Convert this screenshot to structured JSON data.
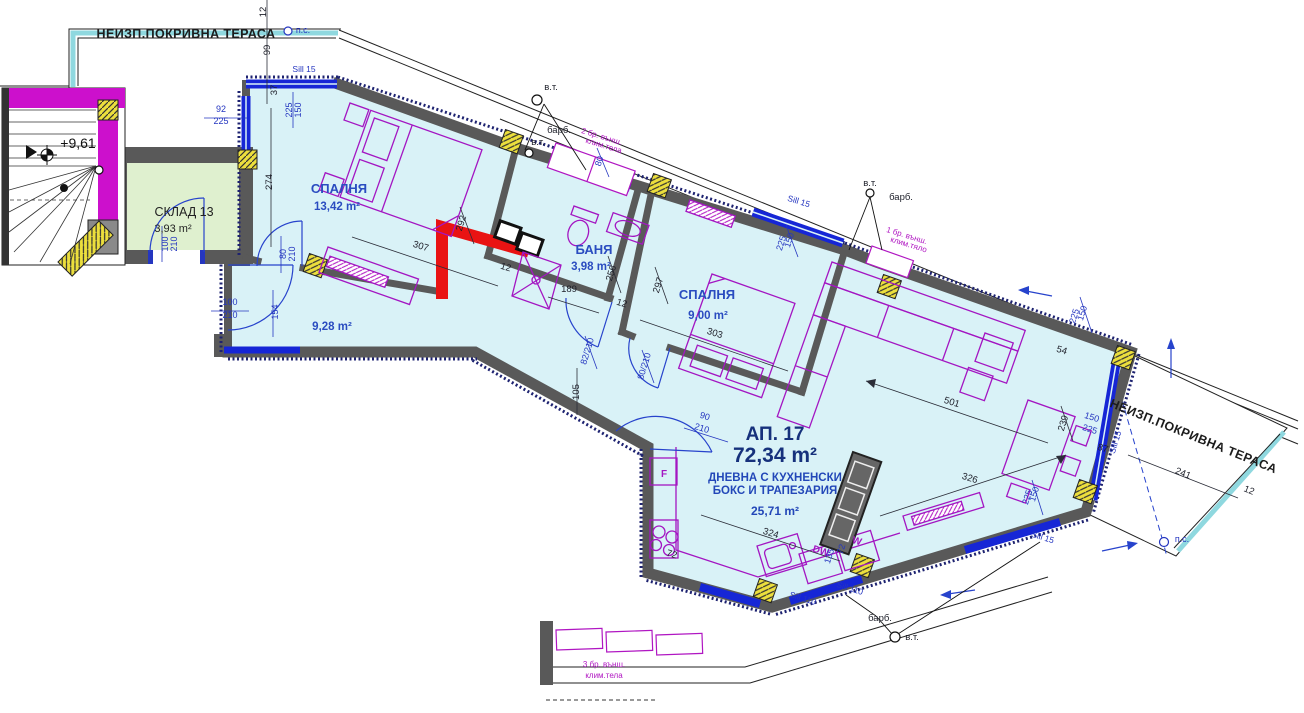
{
  "plan": {
    "apartment_no": "АП. 17",
    "apartment_area": "72,34 m²",
    "level_mark": "+9,61",
    "rooms": [
      {
        "name": "СПАЛНЯ",
        "area": "13,42 m²"
      },
      {
        "name": "БАНЯ",
        "area": "3,98 m²"
      },
      {
        "name": "СПАЛНЯ",
        "area": "9,00 m²"
      },
      {
        "name": "ДНЕВНА С КУХНЕНСКИ БОКС И ТРАПЕЗАРИЯ",
        "area": "25,71 m²"
      },
      {
        "name": "КОРИДОР",
        "area": "9,28 m²"
      },
      {
        "name": "СКЛАД 13",
        "area": "3,93 m²"
      }
    ],
    "terraces": [
      "НЕИЗП.ПОКРИВНА ТЕРАСА",
      "НЕИЗП.ПОКРИВНА ТЕРАСА"
    ],
    "colors": {
      "floor": "#d9f2f7",
      "storage": "#dff0cf",
      "wall": "#595959",
      "window": "#1626d6",
      "furniture": "#a316c2",
      "magenta_wall": "#cc10cc",
      "highlight": "#e91313",
      "vent": "#ecdf3d",
      "edge_cyan": "#8fd8df"
    }
  },
  "texts": [
    {
      "t": "НЕИЗП.ПОКРИВНА ТЕРАСА",
      "x": 186,
      "y": 38,
      "r": 0,
      "c": "tL",
      "n": "terrace-top-label"
    },
    {
      "t": "п.с.",
      "x": 303,
      "y": 33,
      "r": 0,
      "c": "dim",
      "n": "pc-label"
    },
    {
      "t": "12",
      "x": 266,
      "y": 12,
      "r": -90,
      "c": "blk",
      "n": "dim-label"
    },
    {
      "t": "99",
      "x": 270,
      "y": 50,
      "r": -90,
      "c": "blk",
      "n": "dim-label"
    },
    {
      "t": "Sill 15",
      "x": 304,
      "y": 72,
      "r": 0,
      "c": "sill",
      "n": "sill-label"
    },
    {
      "t": "92",
      "x": 221,
      "y": 112,
      "r": 0,
      "c": "dim",
      "n": "dim-label"
    },
    {
      "t": "225",
      "x": 221,
      "y": 124,
      "r": 0,
      "c": "dim",
      "n": "dim-label"
    },
    {
      "t": "150",
      "x": 301,
      "y": 110,
      "r": -90,
      "c": "dim",
      "n": "dim-label"
    },
    {
      "t": "225",
      "x": 292,
      "y": 110,
      "r": -90,
      "c": "dim",
      "n": "dim-label"
    },
    {
      "t": "37",
      "x": 277,
      "y": 90,
      "r": -90,
      "c": "blk",
      "n": "dim-label"
    },
    {
      "t": "274",
      "x": 272,
      "y": 182,
      "r": -90,
      "c": "blk",
      "n": "dim-label"
    },
    {
      "t": "+9,61",
      "x": 78,
      "y": 148,
      "r": 0,
      "c": "lvl",
      "n": "level-mark"
    },
    {
      "t": "СКЛАД 13",
      "x": 184,
      "y": 216,
      "r": 0,
      "c": "store",
      "n": "room-label-storage"
    },
    {
      "t": "3,93 m²",
      "x": 173,
      "y": 232,
      "r": 0,
      "c": "storeA",
      "n": "room-area-storage"
    },
    {
      "t": "100",
      "x": 168,
      "y": 244,
      "r": -90,
      "c": "dim",
      "n": "dim-label"
    },
    {
      "t": "210",
      "x": 177,
      "y": 244,
      "r": -90,
      "c": "dim",
      "n": "dim-label"
    },
    {
      "t": "100",
      "x": 230,
      "y": 305,
      "r": 0,
      "c": "dim",
      "n": "dim-label"
    },
    {
      "t": "210",
      "x": 230,
      "y": 318,
      "r": 0,
      "c": "dim",
      "n": "dim-label"
    },
    {
      "t": "154",
      "x": 278,
      "y": 312,
      "r": -90,
      "c": "dim",
      "n": "dim-label"
    },
    {
      "t": "80",
      "x": 286,
      "y": 254,
      "r": -90,
      "c": "dim",
      "n": "dim-label"
    },
    {
      "t": "210",
      "x": 295,
      "y": 254,
      "r": -90,
      "c": "dim",
      "n": "dim-label"
    },
    {
      "t": "СПАЛНЯ",
      "x": 339,
      "y": 193,
      "r": 0,
      "c": "room",
      "n": "room-label-bedroom1"
    },
    {
      "t": "13,42 m²",
      "x": 337,
      "y": 210,
      "r": 0,
      "c": "area",
      "n": "room-area-bedroom1"
    },
    {
      "t": "307",
      "x": 420,
      "y": 249,
      "r": 17,
      "c": "blk",
      "n": "dim-label"
    },
    {
      "t": "292",
      "x": 464,
      "y": 224,
      "r": -73,
      "c": "blk",
      "n": "dim-label"
    },
    {
      "t": "12",
      "x": 505,
      "y": 270,
      "r": 17,
      "c": "blk",
      "n": "dim-label"
    },
    {
      "t": "9,28 m²",
      "x": 332,
      "y": 330,
      "r": 0,
      "c": "area",
      "n": "room-area-hall"
    },
    {
      "t": "в.т.",
      "x": 551,
      "y": 90,
      "r": 0,
      "c": "blk",
      "n": "vt-label"
    },
    {
      "t": "барб.",
      "x": 559,
      "y": 133,
      "r": 0,
      "c": "blk",
      "n": "barb-label"
    },
    {
      "t": "в.т.",
      "x": 538,
      "y": 145,
      "r": 0,
      "c": "blk",
      "n": "vt-label"
    },
    {
      "t": "2 бр. външ.",
      "x": 601,
      "y": 139,
      "r": 17,
      "c": "mag",
      "n": "ac-note"
    },
    {
      "t": "клим.тела",
      "x": 603,
      "y": 148,
      "r": 17,
      "c": "mag",
      "n": "ac-note"
    },
    {
      "t": "80",
      "x": 602,
      "y": 162,
      "r": -73,
      "c": "dim",
      "n": "dim-label"
    },
    {
      "t": "БАНЯ",
      "x": 594,
      "y": 254,
      "r": 0,
      "c": "room",
      "n": "room-label-bath"
    },
    {
      "t": "3,98 m²",
      "x": 591,
      "y": 270,
      "r": 0,
      "c": "area",
      "n": "room-area-bath"
    },
    {
      "t": "256",
      "x": 614,
      "y": 274,
      "r": -73,
      "c": "blk",
      "n": "dim-label"
    },
    {
      "t": "189",
      "x": 569,
      "y": 292,
      "r": 0,
      "c": "blk",
      "n": "dim-label"
    },
    {
      "t": "297",
      "x": 661,
      "y": 286,
      "r": -73,
      "c": "blk",
      "n": "dim-label"
    },
    {
      "t": "СПАЛНЯ",
      "x": 707,
      "y": 299,
      "r": 0,
      "c": "room",
      "n": "room-label-bedroom2"
    },
    {
      "t": "9,00 m²",
      "x": 708,
      "y": 319,
      "r": 0,
      "c": "area",
      "n": "room-area-bedroom2"
    },
    {
      "t": "303",
      "x": 714,
      "y": 336,
      "r": 17,
      "c": "blk",
      "n": "dim-label"
    },
    {
      "t": "12",
      "x": 621,
      "y": 306,
      "r": 17,
      "c": "blk",
      "n": "dim-label"
    },
    {
      "t": "82/210",
      "x": 590,
      "y": 352,
      "r": -73,
      "c": "dim",
      "n": "dim-label"
    },
    {
      "t": "80/210",
      "x": 647,
      "y": 367,
      "r": -73,
      "c": "dim",
      "n": "dim-label"
    },
    {
      "t": "105",
      "x": 579,
      "y": 392,
      "r": -90,
      "c": "blk",
      "n": "dim-label"
    },
    {
      "t": "90",
      "x": 704,
      "y": 419,
      "r": 17,
      "c": "dim",
      "n": "dim-label"
    },
    {
      "t": "210",
      "x": 701,
      "y": 431,
      "r": 17,
      "c": "dim",
      "n": "dim-label"
    },
    {
      "t": "АП. 17",
      "x": 775,
      "y": 440,
      "r": 0,
      "c": "big1",
      "n": "apartment-number"
    },
    {
      "t": "72,34 m²",
      "x": 775,
      "y": 462,
      "r": 0,
      "c": "big2",
      "n": "apartment-area"
    },
    {
      "t": "ДНЕВНА С КУХНЕНСКИ",
      "x": 775,
      "y": 481,
      "r": 0,
      "c": "liv",
      "n": "room-label-living"
    },
    {
      "t": "БОКС И ТРАПЕЗАРИЯ",
      "x": 775,
      "y": 494,
      "r": 0,
      "c": "liv",
      "n": "room-label-living2"
    },
    {
      "t": "25,71 m²",
      "x": 775,
      "y": 515,
      "r": 0,
      "c": "livA",
      "n": "room-area-living"
    },
    {
      "t": "324",
      "x": 770,
      "y": 536,
      "r": 17,
      "c": "blk",
      "n": "dim-label"
    },
    {
      "t": "F",
      "x": 664,
      "y": 477,
      "r": 0,
      "c": "magF",
      "n": "fridge-label"
    },
    {
      "t": "72",
      "x": 671,
      "y": 557,
      "r": 17,
      "c": "blk",
      "n": "dim-label"
    },
    {
      "t": "DW",
      "x": 820,
      "y": 554,
      "r": 17,
      "c": "magF",
      "n": "dishwasher-label"
    },
    {
      "t": "135",
      "x": 832,
      "y": 557,
      "r": -73,
      "c": "dim",
      "n": "dim-label"
    },
    {
      "t": "W",
      "x": 856,
      "y": 544,
      "r": 17,
      "c": "magF",
      "n": "washer-label"
    },
    {
      "t": "72",
      "x": 844,
      "y": 550,
      "r": -73,
      "c": "dim",
      "n": "dim-label"
    },
    {
      "t": "Sill 110",
      "x": 802,
      "y": 601,
      "r": 17,
      "c": "sill",
      "n": "sill-label"
    },
    {
      "t": "Sill 110",
      "x": 849,
      "y": 591,
      "r": 17,
      "c": "sill",
      "n": "sill-label"
    },
    {
      "t": "Sill 15",
      "x": 1042,
      "y": 540,
      "r": 17,
      "c": "sill",
      "n": "sill-label"
    },
    {
      "t": "барб.",
      "x": 880,
      "y": 621,
      "r": 0,
      "c": "blk",
      "n": "barb-label"
    },
    {
      "t": "в.т.",
      "x": 912,
      "y": 640,
      "r": 0,
      "c": "blk",
      "n": "vt-label"
    },
    {
      "t": "501",
      "x": 951,
      "y": 405,
      "r": 17,
      "c": "blk",
      "n": "dim-label"
    },
    {
      "t": "326",
      "x": 969,
      "y": 481,
      "r": 17,
      "c": "blk",
      "n": "dim-label"
    },
    {
      "t": "Sill 15",
      "x": 798,
      "y": 204,
      "r": 17,
      "c": "sill",
      "n": "sill-label"
    },
    {
      "t": "150",
      "x": 792,
      "y": 241,
      "r": -73,
      "c": "dim",
      "n": "dim-label"
    },
    {
      "t": "225",
      "x": 784,
      "y": 244,
      "r": -73,
      "c": "dim",
      "n": "dim-label"
    },
    {
      "t": "в.т.",
      "x": 870,
      "y": 186,
      "r": 0,
      "c": "blk",
      "n": "vt-label"
    },
    {
      "t": "барб.",
      "x": 901,
      "y": 200,
      "r": 0,
      "c": "blk",
      "n": "barb-label"
    },
    {
      "t": "1 бр. външ.",
      "x": 906,
      "y": 238,
      "r": 17,
      "c": "mag",
      "n": "ac-note"
    },
    {
      "t": "клим.тяло",
      "x": 908,
      "y": 247,
      "r": 17,
      "c": "mag",
      "n": "ac-note"
    },
    {
      "t": "150",
      "x": 1085,
      "y": 314,
      "r": -73,
      "c": "dim",
      "n": "dim-label"
    },
    {
      "t": "225",
      "x": 1077,
      "y": 317,
      "r": -73,
      "c": "dim",
      "n": "dim-label"
    },
    {
      "t": "54",
      "x": 1061,
      "y": 353,
      "r": 17,
      "c": "blk",
      "n": "dim-label"
    },
    {
      "t": "239",
      "x": 1066,
      "y": 424,
      "r": -73,
      "c": "blk",
      "n": "dim-label"
    },
    {
      "t": "150",
      "x": 1091,
      "y": 420,
      "r": 17,
      "c": "dim",
      "n": "dim-label"
    },
    {
      "t": "225",
      "x": 1089,
      "y": 432,
      "r": 17,
      "c": "dim",
      "n": "dim-label"
    },
    {
      "t": "87",
      "x": 1102,
      "y": 451,
      "r": 17,
      "c": "blk",
      "n": "dim-label"
    },
    {
      "t": "Sill 15",
      "x": 1118,
      "y": 443,
      "r": -73,
      "c": "sill",
      "n": "sill-label"
    },
    {
      "t": "НЕИЗП.ПОКРИВНА ТЕРАСА",
      "x": 1192,
      "y": 440,
      "r": 22,
      "c": "tL",
      "n": "terrace-right-label"
    },
    {
      "t": "241",
      "x": 1182,
      "y": 476,
      "r": 22,
      "c": "blk",
      "n": "dim-label"
    },
    {
      "t": "12",
      "x": 1248,
      "y": 493,
      "r": 22,
      "c": "blk",
      "n": "dim-label"
    },
    {
      "t": "п.с.",
      "x": 1182,
      "y": 542,
      "r": 0,
      "c": "dim",
      "n": "pc-label"
    },
    {
      "t": "3 бр. външ.",
      "x": 604,
      "y": 667,
      "r": 0,
      "c": "mag",
      "n": "ac-note"
    },
    {
      "t": "клим.тела",
      "x": 604,
      "y": 678,
      "r": 0,
      "c": "mag",
      "n": "ac-note"
    },
    {
      "t": "150",
      "x": 1037,
      "y": 495,
      "r": -73,
      "c": "dim",
      "n": "dim-label"
    },
    {
      "t": "225",
      "x": 1030,
      "y": 498,
      "r": -73,
      "c": "dim",
      "n": "dim-label"
    }
  ]
}
